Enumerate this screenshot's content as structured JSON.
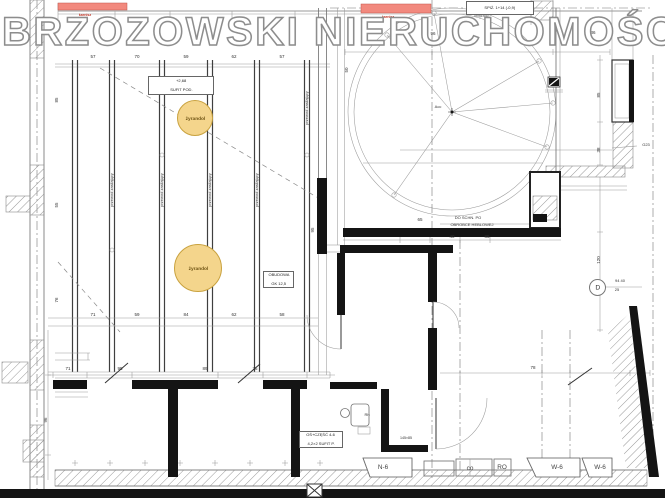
{
  "watermark": {
    "text": "BRZOZOWSKI NIERUCHOMOŚCI"
  },
  "colors": {
    "highlight": "#F2897E",
    "highlight_text": "#C03A2B",
    "chandelier_fill": "#F4D58C",
    "chandelier_border": "#C9A23F",
    "wall": "#141414"
  },
  "chandeliers": [
    {
      "label": "żyrandol",
      "x": 194,
      "y": 117,
      "r": 17
    },
    {
      "label": "żyrandol",
      "x": 197,
      "y": 267,
      "r": 23
    }
  ],
  "boxes": {
    "ceiling": {
      "line1": "+2,68",
      "line2": "SUFIT POD."
    },
    "pantry": {
      "line1": "SPIŻ. 1+14 (-0,9)",
      "line2": "obniżając."
    },
    "mid": {
      "line1": "OŚ+CZĘŚĆ 4-6",
      "line2": "4,2×2 SUFIT P."
    },
    "casing": {
      "line1": "OBUDOWA",
      "line2": "GK 12,5"
    }
  },
  "axis_marker": {
    "letter": "D"
  },
  "window_labels": [
    {
      "t": "N-6",
      "x": 383,
      "y": 467
    },
    {
      "t": "co",
      "x": 470,
      "y": 468
    },
    {
      "t": "RO",
      "x": 502,
      "y": 467
    },
    {
      "t": "W-6",
      "x": 557,
      "y": 467
    },
    {
      "t": "W-6",
      "x": 600,
      "y": 467
    }
  ],
  "annotations": [
    {
      "x": 93,
      "y": 57,
      "t": "57"
    },
    {
      "x": 137,
      "y": 57,
      "t": "70"
    },
    {
      "x": 186,
      "y": 57,
      "t": "59"
    },
    {
      "x": 234,
      "y": 57,
      "t": "62"
    },
    {
      "x": 282,
      "y": 57,
      "t": "57"
    },
    {
      "x": 93,
      "y": 315,
      "t": "71"
    },
    {
      "x": 137,
      "y": 315,
      "t": "59"
    },
    {
      "x": 186,
      "y": 315,
      "t": "84"
    },
    {
      "x": 234,
      "y": 315,
      "t": "62"
    },
    {
      "x": 282,
      "y": 315,
      "t": "58"
    },
    {
      "x": 68,
      "y": 369,
      "t": "71"
    },
    {
      "x": 120,
      "y": 369,
      "t": "95"
    },
    {
      "x": 205,
      "y": 369,
      "t": "89"
    },
    {
      "x": 255,
      "y": 369,
      "t": "76"
    },
    {
      "x": 57,
      "y": 100,
      "t": "85",
      "r": -90
    },
    {
      "x": 57,
      "y": 205,
      "t": "55",
      "r": -90
    },
    {
      "x": 57,
      "y": 300,
      "t": "76",
      "r": -90
    },
    {
      "x": 46,
      "y": 420,
      "t": "96",
      "r": -90
    },
    {
      "x": 347,
      "y": 70,
      "t": "50",
      "r": -90
    },
    {
      "x": 433,
      "y": 34,
      "t": "96"
    },
    {
      "x": 593,
      "y": 33,
      "t": "36"
    },
    {
      "x": 420,
      "y": 220,
      "t": "65"
    },
    {
      "x": 452,
      "y": 237,
      "t": "40"
    },
    {
      "x": 487,
      "y": 237,
      "t": "85"
    },
    {
      "x": 468,
      "y": 218,
      "t": "DO SCHN. PO",
      "s": 4
    },
    {
      "x": 472,
      "y": 225,
      "t": "OBROBCE HEBLOWEJ",
      "s": 4
    },
    {
      "x": 599,
      "y": 95,
      "t": "85",
      "r": -90
    },
    {
      "x": 599,
      "y": 150,
      "t": "38",
      "r": -90
    },
    {
      "x": 599,
      "y": 260,
      "t": "120",
      "r": -90
    },
    {
      "x": 620,
      "y": 281,
      "t": "94 40",
      "s": 4
    },
    {
      "x": 617,
      "y": 290,
      "t": "25",
      "s": 4
    },
    {
      "x": 646,
      "y": 145,
      "t": "G23",
      "s": 4
    },
    {
      "x": 438,
      "y": 107,
      "t": "Acc",
      "s": 4
    },
    {
      "x": 533,
      "y": 368,
      "t": "78"
    },
    {
      "x": 367,
      "y": 415,
      "t": "Rh",
      "s": 4
    },
    {
      "x": 406,
      "y": 438,
      "t": "145×85",
      "s": 3.6
    },
    {
      "x": 313,
      "y": 230,
      "t": "95",
      "r": -90
    },
    {
      "x": 112,
      "y": 190,
      "t": "przewod zasilający",
      "r": -90,
      "s": 4
    },
    {
      "x": 162,
      "y": 190,
      "t": "przewod zasilający",
      "r": -90,
      "s": 4
    },
    {
      "x": 210,
      "y": 190,
      "t": "przewod zasilający",
      "r": -90,
      "s": 4
    },
    {
      "x": 257,
      "y": 190,
      "t": "przewod zasilający",
      "r": -90,
      "s": 4
    },
    {
      "x": 307,
      "y": 108,
      "t": "przewod zasilający",
      "r": -90,
      "s": 4
    },
    {
      "x": 85,
      "y": 15,
      "t": "karnisz",
      "s": 3.6,
      "c": "red"
    },
    {
      "x": 388,
      "y": 17,
      "t": "karnisz",
      "s": 3.6,
      "c": "red"
    }
  ]
}
